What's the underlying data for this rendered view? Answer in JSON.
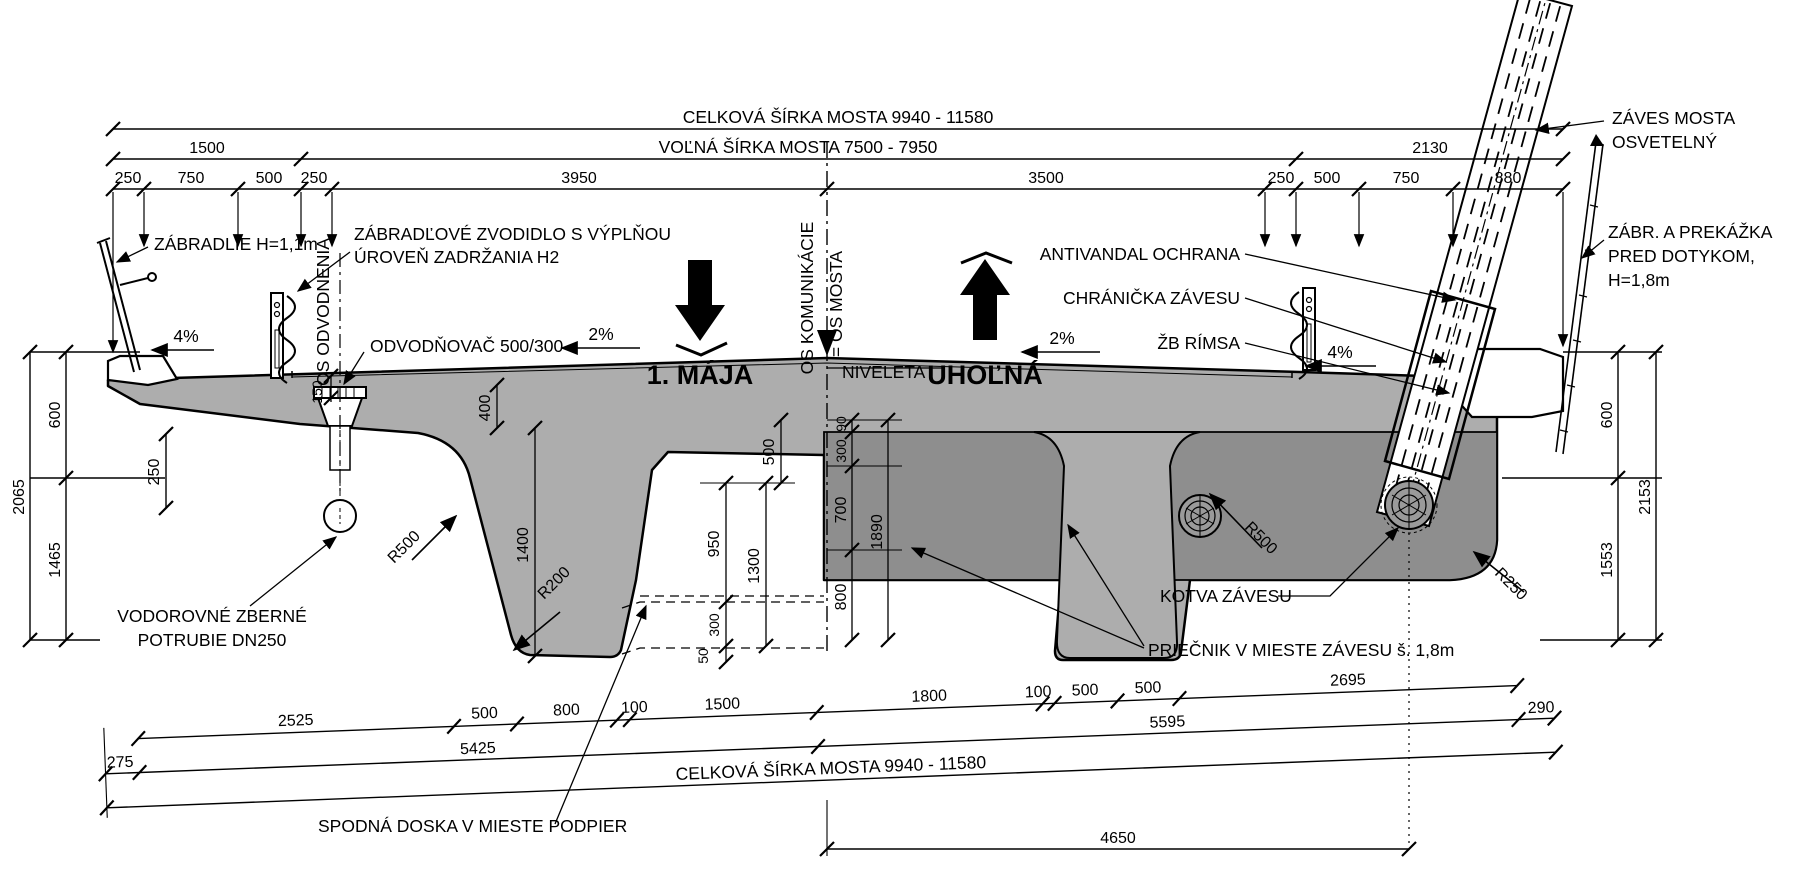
{
  "colors": {
    "concrete_light": "#adadad",
    "concrete_dark": "#8e8e8e",
    "line": "#000000",
    "background": "#ffffff"
  },
  "top": {
    "overall": "CELKOVÁ ŠÍRKA MOSTA 9940 - 11580",
    "free_width": "VOĽNÁ ŠÍRKA MOSTA 7500 - 7950",
    "left_group": "1500",
    "right_group": "2130",
    "row3": [
      "250",
      "750",
      "500",
      "250",
      "3950",
      "3500",
      "250",
      "500",
      "750",
      "880"
    ]
  },
  "left": {
    "d600": "600",
    "d1465": "1465",
    "d2065": "2065",
    "tip": "250"
  },
  "right": {
    "d600": "600",
    "d1553": "1553",
    "d2153": "2153"
  },
  "section": {
    "d400": "400",
    "d1400": "1400",
    "d500": "500",
    "d950": "950",
    "d1300": "1300",
    "d300": "300",
    "d50": "50",
    "d90": "90",
    "d300r": "300",
    "d700": "700",
    "d800": "800",
    "d1890": "1890",
    "d150": "150"
  },
  "radii": {
    "left_haunch": "R500",
    "web_foot": "R200",
    "right_haunch": "R500",
    "edge": "R250"
  },
  "slopes": {
    "walk_left": "4%",
    "road_left": "2%",
    "road_right": "2%",
    "walk_right": "4%"
  },
  "labels": {
    "zabradlie": "ZÁBRADLIE H=1,1m",
    "zvodidlo1": "ZÁBRADĽOVÉ ZVODIDLO S VÝPLŇOU",
    "zvodidlo2": "ÚROVEŇ ZADRŽANIA H2",
    "os_odvodnenia": "OS ODVODNENIA",
    "odvodnovac": "ODVODŇOVAČ 500/300",
    "maja": "1. MÁJA",
    "os_komunikacie": "OS KOMUNIKÁCIE",
    "os_mosta": "= OS MOSTA",
    "niveleta": "NIVELETA",
    "uholna": "UHOĽNÁ",
    "antivandal": "ANTIVANDAL OCHRANA",
    "chranicka": "CHRÁNIČKA ZÁVESU",
    "zb_rimsa": "ŽB RÍMSA",
    "zaves1": "ZÁVES MOSTA",
    "zaves2": "OSVETELNÝ",
    "zabrana1": "ZÁBR. A PREKÁŽKA",
    "zabrana2": "PRED DOTYKOM,",
    "zabrana3": "H=1,8m",
    "potrubie1": "VODOROVNÉ ZBERNÉ",
    "potrubie2": "POTRUBIE DN250",
    "kotva": "KOTVA ZÁVESU",
    "priecnik": "PRIEČNIK V MIESTE ZÁVESU š. 1,8m",
    "spodna": "SPODNÁ DOSKA V MIESTE PODPIER"
  },
  "bottom": {
    "row1": [
      "2525",
      "500",
      "800",
      "100",
      "1500",
      "1800",
      "100",
      "500",
      "500",
      "2695"
    ],
    "row2": [
      "275",
      "5425",
      "5595",
      "290"
    ],
    "overall": "CELKOVÁ ŠÍRKA MOSTA 9940 - 11580",
    "anchor_span": "4650"
  }
}
